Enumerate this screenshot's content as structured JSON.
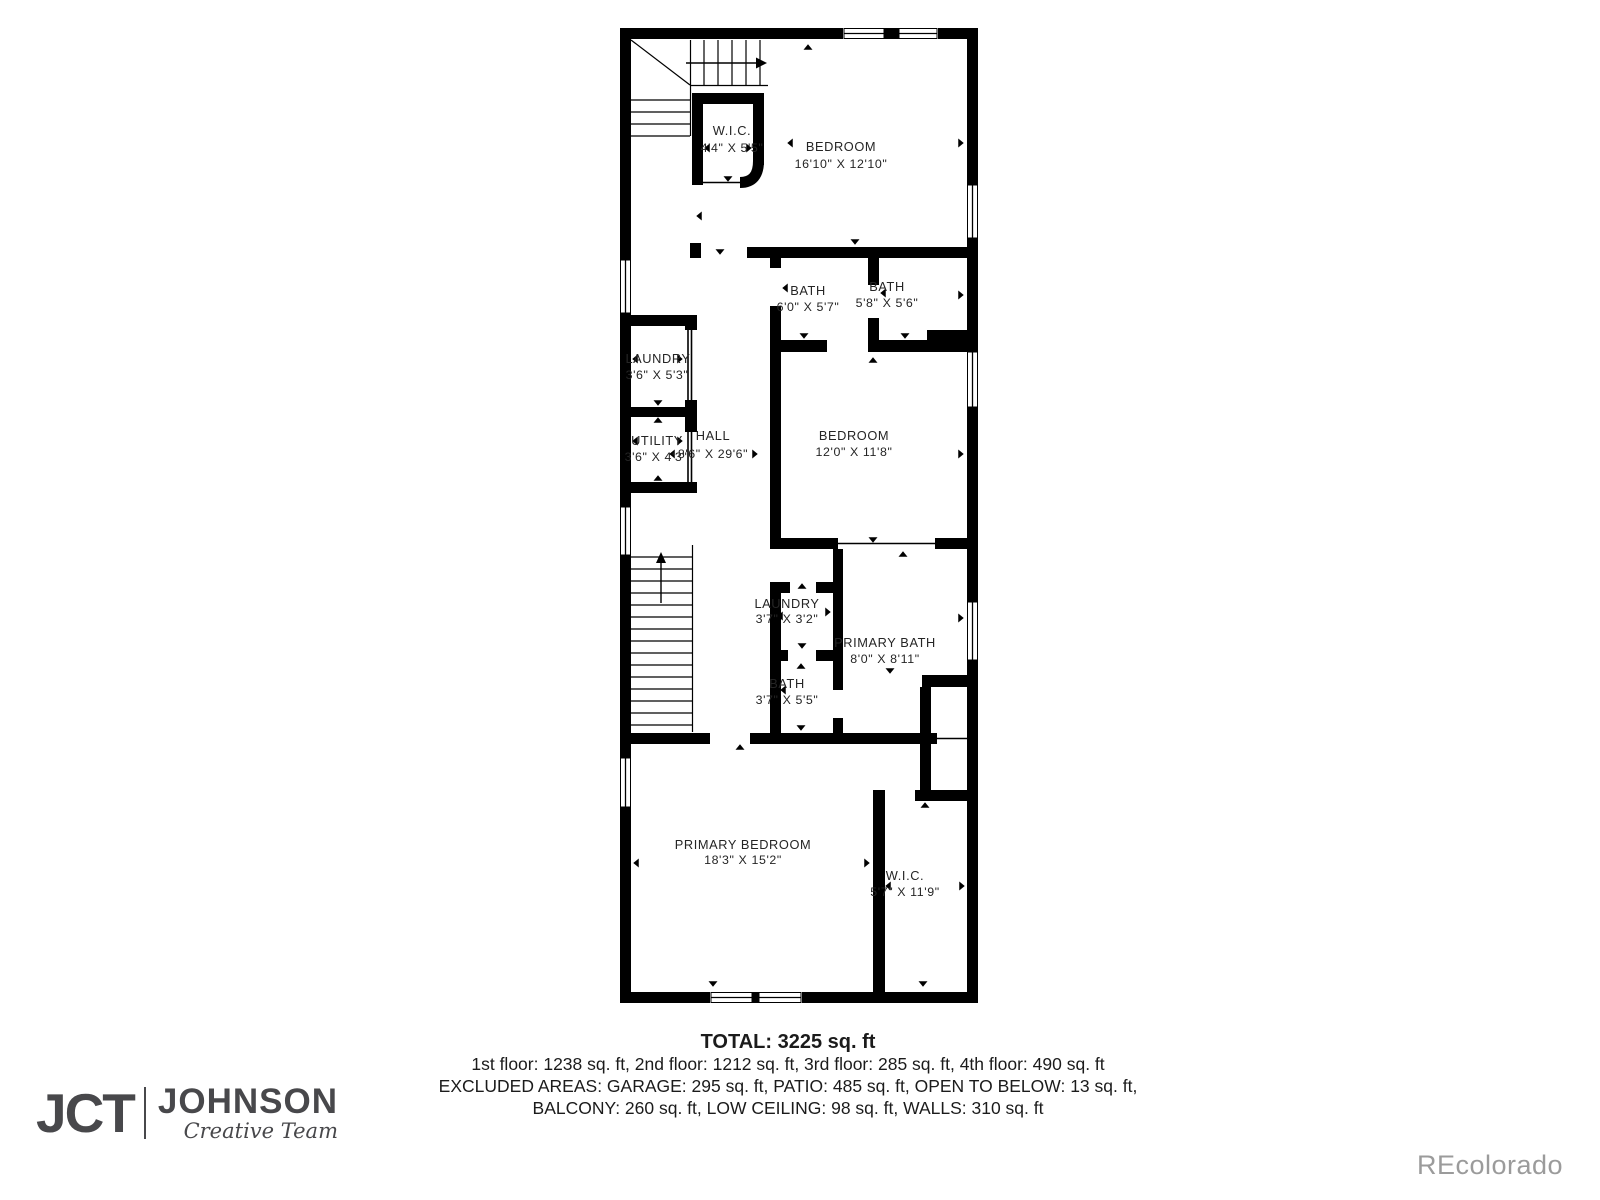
{
  "plan": {
    "rooms": [
      {
        "id": "wic-top",
        "name": "W.I.C.",
        "dims": "4'4\" X 5'5\""
      },
      {
        "id": "bedroom-top",
        "name": "BEDROOM",
        "dims": "16'10\" X 12'10\""
      },
      {
        "id": "bath-1",
        "name": "BATH",
        "dims": "6'0\" X 5'7\""
      },
      {
        "id": "bath-2",
        "name": "BATH",
        "dims": "5'8\" X 5'6\""
      },
      {
        "id": "laundry-1",
        "name": "LAUNDRY",
        "dims": "3'6\" X 5'3\""
      },
      {
        "id": "utility",
        "name": "UTILITY",
        "dims": "3'6\" X 4'3\""
      },
      {
        "id": "hall",
        "name": "HALL",
        "dims": "8'6\" X 29'6\""
      },
      {
        "id": "bedroom-mid",
        "name": "BEDROOM",
        "dims": "12'0\" X 11'8\""
      },
      {
        "id": "laundry-2",
        "name": "LAUNDRY",
        "dims": "3'7\" X 3'2\""
      },
      {
        "id": "primary-bath",
        "name": "PRIMARY BATH",
        "dims": "8'0\" X 8'11\""
      },
      {
        "id": "bath-3",
        "name": "BATH",
        "dims": "3'7\" X 5'5\""
      },
      {
        "id": "primary-bedroom",
        "name": "PRIMARY BEDROOM",
        "dims": "18'3\" X 15'2\""
      },
      {
        "id": "wic-bottom",
        "name": "W.I.C.",
        "dims": "5'7\" X 11'9\""
      }
    ],
    "footer": {
      "total": "TOTAL: 3225 sq. ft",
      "floors": "1st floor: 1238 sq. ft, 2nd floor: 1212 sq. ft, 3rd floor: 285 sq. ft, 4th floor: 490 sq. ft",
      "excluded_1": "EXCLUDED AREAS: GARAGE: 295 sq. ft, PATIO: 485 sq. ft, OPEN TO BELOW: 13 sq. ft,",
      "excluded_2": "BALCONY: 260 sq. ft, LOW CEILING: 98 sq. ft, WALLS: 310 sq. ft"
    },
    "logo": {
      "monogram": "JCT",
      "name": "JOHNSON",
      "tagline": "Creative Team"
    },
    "watermark": "REcolorado",
    "colors": {
      "wall": "#000000",
      "label_text": "#252525",
      "logo": "#48484b",
      "watermark": "#9b9b9b",
      "background": "#ffffff"
    }
  }
}
